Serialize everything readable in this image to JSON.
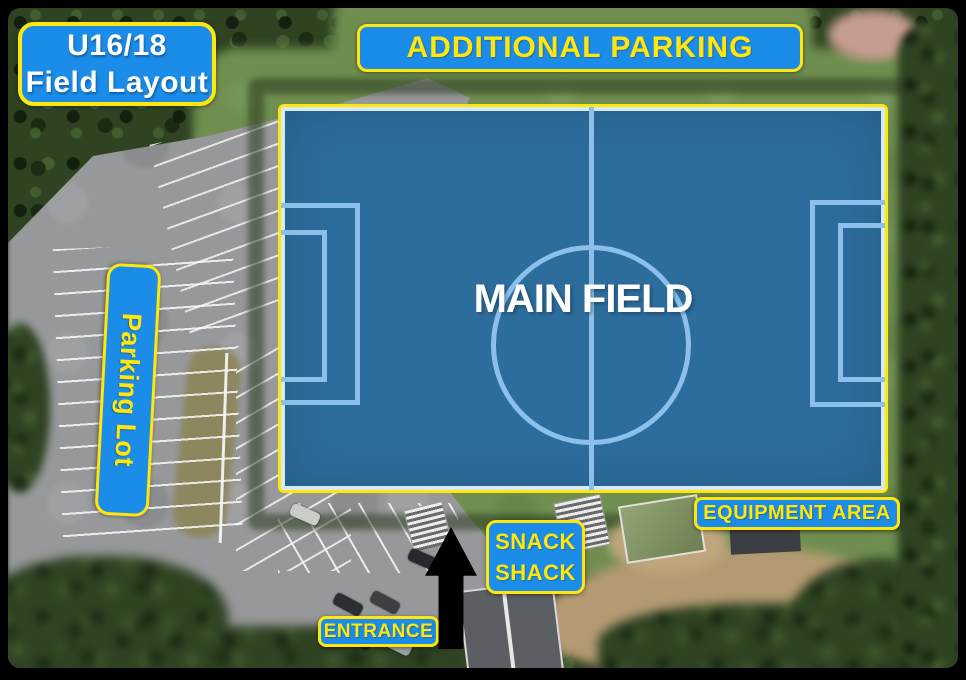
{
  "title_card": {
    "line1": "U16/18",
    "line2": "Field Layout"
  },
  "labels": {
    "additional_parking": "ADDITIONAL PARKING",
    "main_field": "MAIN FIELD",
    "parking_lot": "Parking Lot",
    "equipment_area": "EQUIPMENT AREA",
    "snack_shack_line1": "SNACK",
    "snack_shack_line2": "SHACK",
    "entrance": "ENTRANCE"
  },
  "icons": {
    "entrance_arrow": "up-arrow"
  },
  "colors": {
    "label_background": "#1b8de9",
    "label_border": "#ffe70d",
    "label_text_yellow": "#ffe70d",
    "title_text": "#ffffff",
    "field_overlay_fill": "#2d6d9c",
    "field_marking": "#8bc0ea",
    "field_border": "#ffe70a",
    "main_field_text": "#ffffff",
    "entrance_arrow": "#000000"
  }
}
